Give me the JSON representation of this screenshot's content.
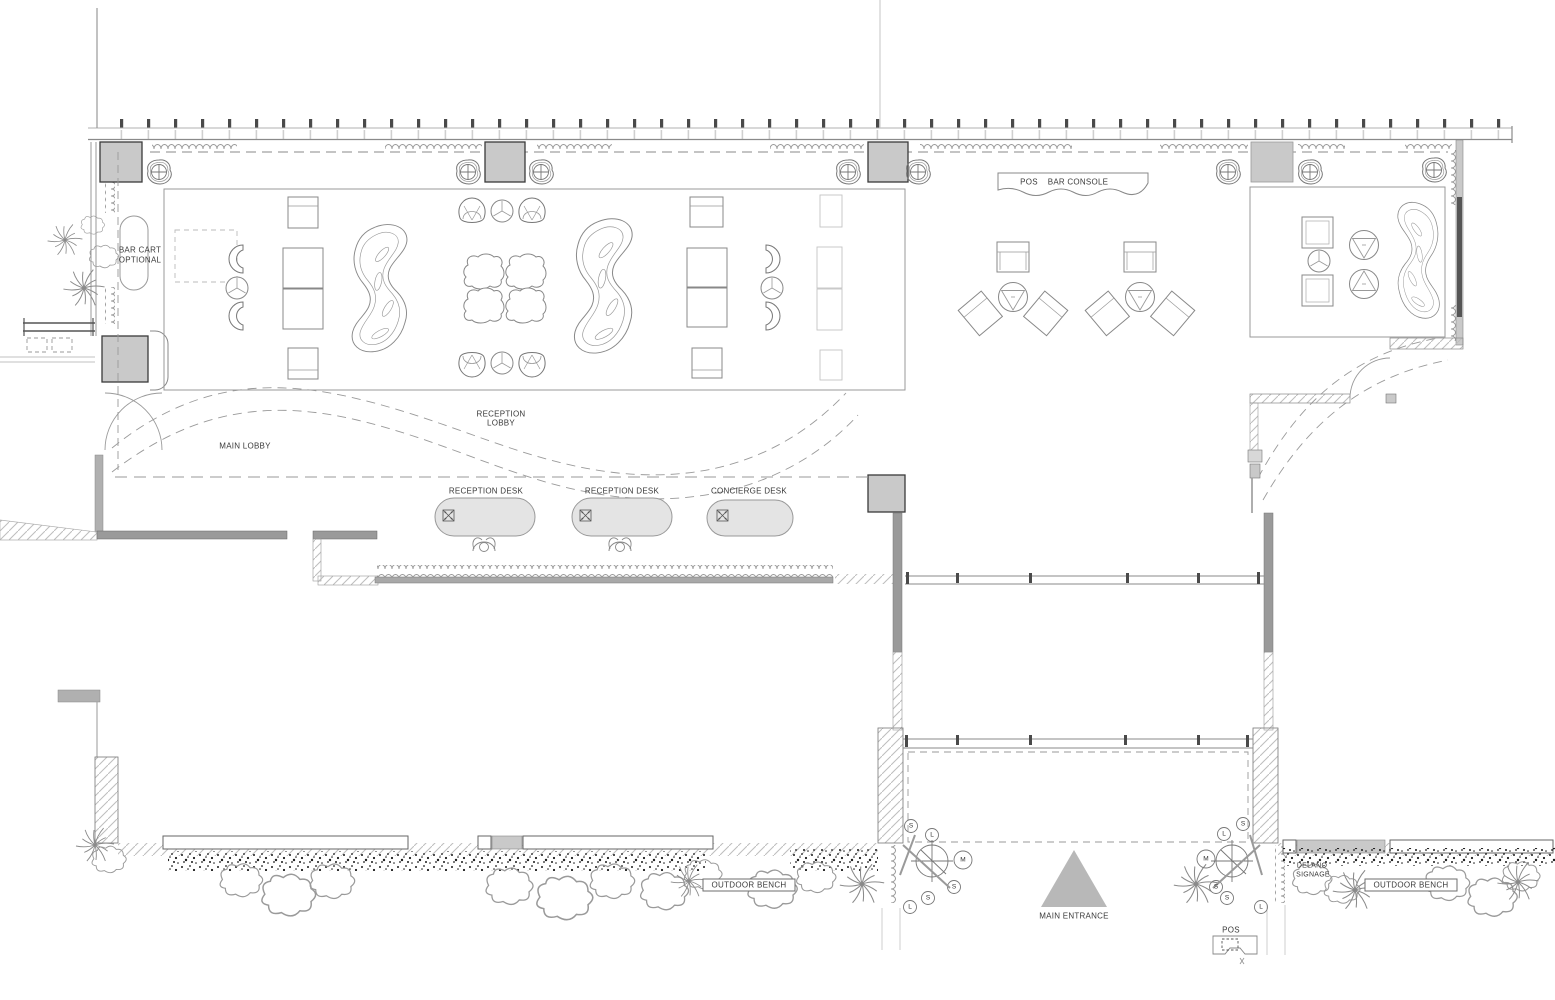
{
  "labels": {
    "bar_cart_line1": "BAR CART",
    "bar_cart_line2": "OPTIONAL",
    "main_lobby": "MAIN LOBBY",
    "reception_lobby_line1": "RECEPTION",
    "reception_lobby_line2": "LOBBY",
    "desk1": "RECEPTION DESK",
    "desk2": "RECEPTION DESK",
    "desk3": "CONCIERGE DESK",
    "pos": "POS",
    "bar_console": "BAR CONSOLE",
    "outdoor_bench_left": "OUTDOOR BENCH",
    "outdoor_bench_right": "OUTDOOR BENCH",
    "main_entrance": "MAIN ENTRANCE",
    "delano_line1": "DELANO",
    "delano_line2": "SIGNAGE",
    "pos_station": "POS"
  },
  "plant_tags": {
    "left": [
      "S",
      "L",
      "M",
      "S",
      "S",
      "L"
    ],
    "right": [
      "S",
      "L",
      "M",
      "S",
      "S",
      "L"
    ]
  },
  "colors": {
    "line": "#8a8a8a",
    "wall_fill": "#9a9a9a",
    "column_fill": "#c9c9c9",
    "desk_fill": "#e4e4e4",
    "entrance_marker": "#b8b8b8",
    "queue_bar": "#a8a8a8",
    "text": "#3a3a3a"
  }
}
